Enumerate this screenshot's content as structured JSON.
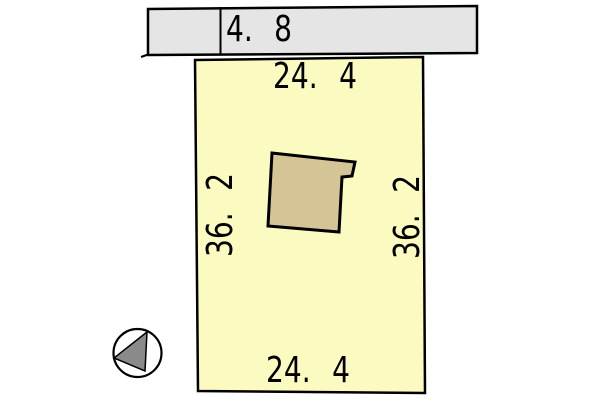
{
  "road": {
    "width_label": "4. 8"
  },
  "parcel": {
    "top_label": "24. 4",
    "bottom_label": "24. 4",
    "left_label": "36. 2",
    "right_label": "36. 2"
  },
  "colors": {
    "road_fill": "#E5E5E5",
    "parcel_fill": "#FBFBC1",
    "building_fill": "#D4C496",
    "compass_triangle_fill": "#8A8A8A",
    "compass_circle_fill": "#FFFFFF",
    "line": "#000000",
    "background": "#FFFFFF"
  },
  "icons": {
    "compass": "north-arrow-icon"
  }
}
